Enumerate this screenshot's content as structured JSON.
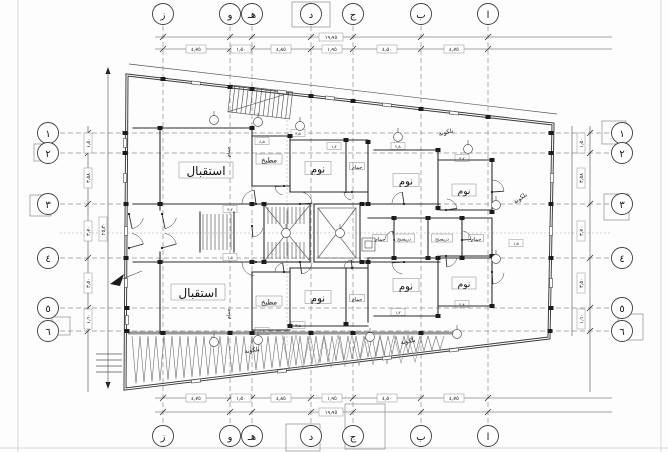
{
  "sheet": {
    "type": "architectural-floor-plan"
  },
  "colors": {
    "paper": "#ffffff",
    "wall": "#2b2b2b",
    "grid_line": "#8f8f8f",
    "dimension_line": "#4a4a4a",
    "text": "#141414",
    "frame": "#d8d8d8"
  },
  "grid": {
    "letters": [
      "ز",
      "و",
      "هـ",
      "د",
      "ج",
      "ب",
      "ا"
    ],
    "numbers": [
      "١",
      "٢",
      "٣",
      "٤",
      "٥",
      "٦"
    ]
  },
  "rooms": {
    "reception": "استقبال",
    "kitchen": "مطبخ",
    "bedroom": "نوم",
    "bathroom": "حمام",
    "dressing": "دريسنج",
    "balcony": "بلكونة"
  },
  "dims": {
    "h_segments": [
      "٤٫٧٥",
      "١٫٥٠",
      "٤٫٨٥",
      "١٫٩٥",
      "٤٫٥٠",
      "٤٫٧٥"
    ],
    "h_total": "١٩٫٩٥",
    "v_segments": [
      "١٫٥٠",
      "٣٫٥٨",
      "٣٫٧٠",
      "٣٫٥٠",
      "١٫٦٠"
    ],
    "v_total": "٢٥٫٣٠",
    "small": [
      "٣٫٥",
      "٤٫٥",
      "١٫٢",
      "٢٫٨",
      "٣٫٢",
      "١٫٥"
    ]
  }
}
